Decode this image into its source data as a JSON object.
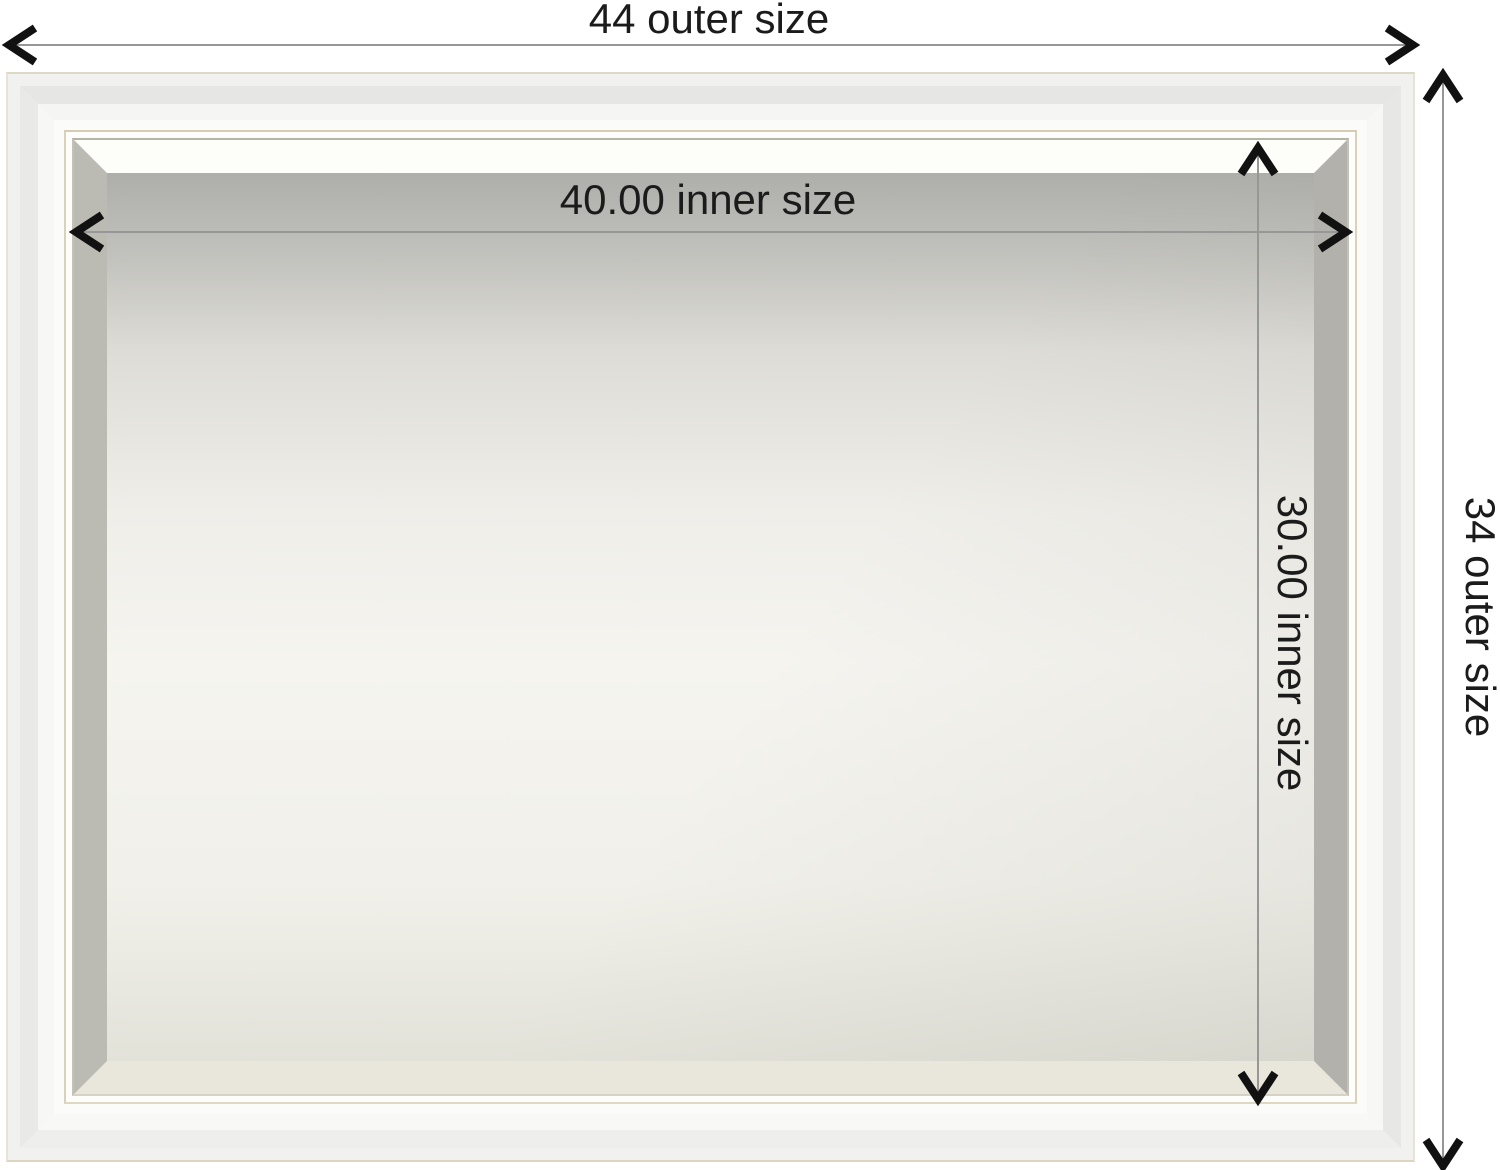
{
  "subject": "framed-beveled-mirror-dimension-diagram",
  "dimensions": {
    "outer_width": {
      "value": "44",
      "label": "44 outer size"
    },
    "outer_height": {
      "value": "34",
      "label": "34 outer size"
    },
    "inner_width": {
      "value": "40.00",
      "label": "40.00 inner size"
    },
    "inner_height": {
      "value": "30.00",
      "label": "30.00 inner size"
    }
  },
  "colors": {
    "background": "#ffffff",
    "dimension_line": "#979797",
    "arrowhead": "#111111",
    "label_text": "#1b1b1b",
    "frame_white": "#f1f1f0",
    "frame_gold_pinstripe": "#d5ccb1",
    "frame_inner_edge": "#b5b2a6",
    "mirror_bevel_top": "#fdfdfa",
    "mirror_top_gray": "#aeaeaa",
    "mirror_center": "#f5f4ef"
  }
}
